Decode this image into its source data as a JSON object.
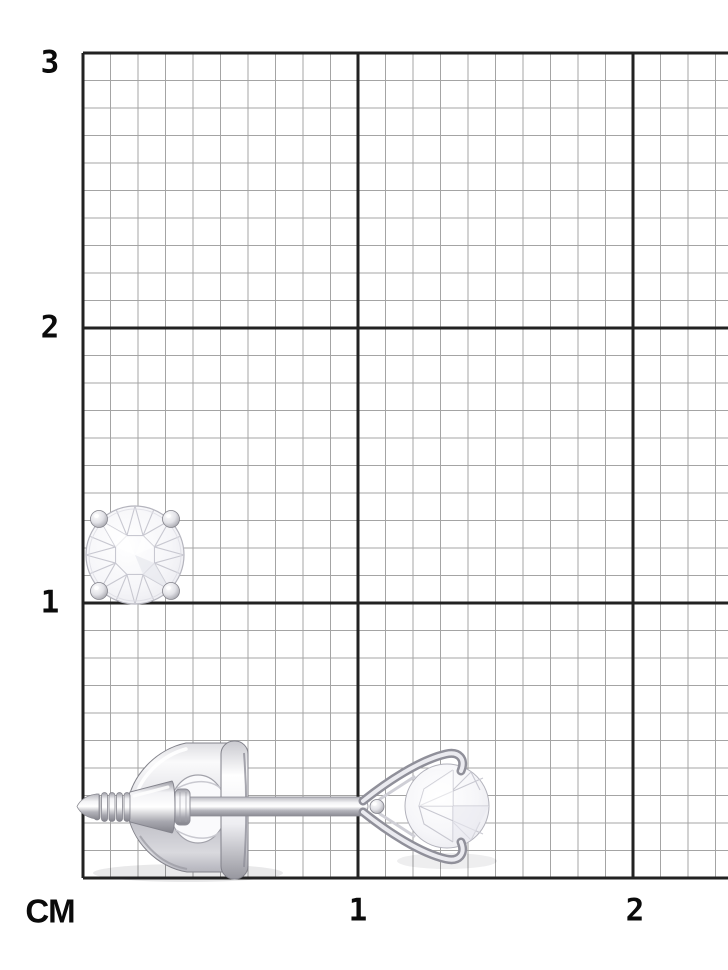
{
  "figure": {
    "title": "diamond stud earring shown to scale on centimeter grid",
    "unit_label": "CM",
    "y_axis_labels": [
      {
        "label": "3",
        "cm": 3
      },
      {
        "label": "2",
        "cm": 2
      },
      {
        "label": "1",
        "cm": 1
      }
    ],
    "x_axis_labels": [
      {
        "label": "1",
        "cm": 1
      },
      {
        "label": "2",
        "cm": 2
      }
    ],
    "grid": {
      "left_px": 83,
      "top_px": 53,
      "bottom_px": 878,
      "right_px": 728,
      "px_per_cm": 275,
      "minor_per_cm": 10,
      "minor_color": "#a4a4a4",
      "major_color": "#222222",
      "minor_width": 1,
      "major_width": 3,
      "background": "#ffffff"
    },
    "objects": {
      "front_view": {
        "name": "diamond-stud-front-view",
        "description": "round brilliant diamond stud, front view, four prong balls",
        "gem_center_x_px": 135,
        "gem_center_y_px": 555,
        "gem_radius_px": 49,
        "table_ratio": 0.43,
        "prong_offset_px": 36,
        "prong_radius_px": 8.5
      },
      "side_view": {
        "name": "diamond-stud-side-view",
        "description": "side view: threaded post with screw-back disc and martini three-prong set diamond",
        "axis_y_px": 807,
        "tip_x_px": 77,
        "gem_center_x_px": 447,
        "gem_radius_px": 42
      }
    },
    "colors": {
      "label_text": "#0b0b0b",
      "metal_highlight": "#ffffff",
      "metal_mid": "#d7d7dc",
      "metal_shadow": "#8a8a92",
      "gem_facet_line": "#c6c6cf",
      "gem_fill": "#f6f6f9"
    }
  }
}
